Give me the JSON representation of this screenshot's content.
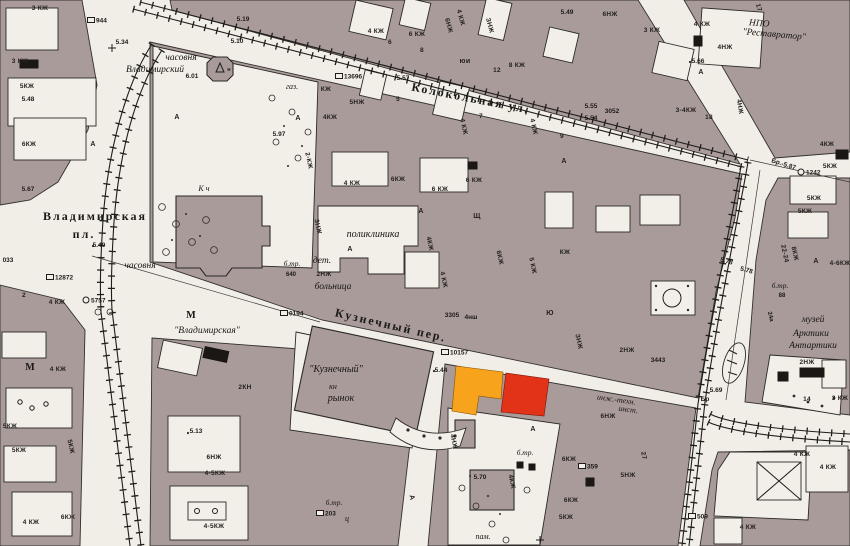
{
  "map": {
    "colors": {
      "paper": "#f1eee7",
      "block": "#a89b9a",
      "outline": "#33302d",
      "highlight_orange": "#F7A41C",
      "highlight_red": "#E23318"
    },
    "highlights": {
      "orange_building": {
        "color": "#F7A41C",
        "description": "highlighted building orange"
      },
      "red_building": {
        "color": "#E23318",
        "description": "highlighted building red"
      }
    },
    "street_labels": [
      {
        "text": "Колокольная ул.",
        "x": 470,
        "y": 102,
        "r": 11
      },
      {
        "text": "Кузнечный пер.",
        "x": 390,
        "y": 329,
        "r": 13
      },
      {
        "text": "Владимирская",
        "x": 95,
        "y": 220,
        "r": 0
      },
      {
        "text": "пл.",
        "x": 84,
        "y": 238,
        "r": 0
      }
    ],
    "place_labels": [
      {
        "text": "часовня",
        "x": 181,
        "y": 60
      },
      {
        "text": "Владимирский",
        "x": 155,
        "y": 72
      },
      {
        "text": "газ.",
        "x": 292,
        "y": 89,
        "s": 8
      },
      {
        "text": "К ч",
        "x": 204,
        "y": 191,
        "s": 8
      },
      {
        "text": "часовня",
        "x": 140,
        "y": 268
      },
      {
        "text": "М",
        "x": 191,
        "y": 318,
        "s": 10,
        "b": 1
      },
      {
        "text": "\"Владимирская\"",
        "x": 207,
        "y": 333
      },
      {
        "text": "поликлиника",
        "x": 373,
        "y": 237,
        "s": 10
      },
      {
        "text": "дет.",
        "x": 322,
        "y": 263
      },
      {
        "text": "больница",
        "x": 333,
        "y": 289
      },
      {
        "text": "б.тр.",
        "x": 292,
        "y": 266,
        "s": 7.5
      },
      {
        "text": "\"Кузнечный\"",
        "x": 336,
        "y": 372,
        "s": 10
      },
      {
        "text": "кн",
        "x": 333,
        "y": 389,
        "s": 8
      },
      {
        "text": "рынок",
        "x": 341,
        "y": 401,
        "s": 10
      },
      {
        "text": "НПО",
        "x": 759,
        "y": 26,
        "r": 5
      },
      {
        "text": "\"Реставратор\"",
        "x": 774,
        "y": 37,
        "r": 5
      },
      {
        "text": "музей",
        "x": 813,
        "y": 322
      },
      {
        "text": "Арктики",
        "x": 811,
        "y": 336
      },
      {
        "text": "Антартики",
        "x": 813,
        "y": 348
      },
      {
        "text": "инж.-техн.",
        "x": 616,
        "y": 402,
        "s": 8,
        "r": 8
      },
      {
        "text": "инст.",
        "x": 628,
        "y": 412,
        "s": 8,
        "r": 8
      },
      {
        "text": "б.тр.",
        "x": 525,
        "y": 455,
        "s": 7.5
      },
      {
        "text": "б.тр.",
        "x": 780,
        "y": 288,
        "s": 7.5
      },
      {
        "text": "б.тр.",
        "x": 334,
        "y": 505,
        "s": 7.5
      },
      {
        "text": "пам.",
        "x": 483,
        "y": 539,
        "s": 8
      },
      {
        "text": "М",
        "x": 30,
        "y": 370,
        "s": 10,
        "b": 1
      },
      {
        "text": "ц",
        "x": 347,
        "y": 521,
        "s": 8
      }
    ],
    "building_labels": [
      {
        "text": "3 КЖ",
        "x": 40,
        "y": 10
      },
      {
        "text": "3 КЖ",
        "x": 20,
        "y": 63
      },
      {
        "text": "5КЖ",
        "x": 27,
        "y": 88
      },
      {
        "text": "6КЖ",
        "x": 29,
        "y": 146
      },
      {
        "text": "4 КЖ",
        "x": 376,
        "y": 33
      },
      {
        "text": "6 КЖ",
        "x": 417,
        "y": 36
      },
      {
        "text": "6",
        "x": 390,
        "y": 44
      },
      {
        "text": "8",
        "x": 422,
        "y": 52
      },
      {
        "text": "6НЖ",
        "x": 447,
        "y": 26,
        "r": 75
      },
      {
        "text": "4 КЖ",
        "x": 459,
        "y": 18,
        "r": 75
      },
      {
        "text": "ЗНЖ",
        "x": 488,
        "y": 26,
        "r": 75
      },
      {
        "text": "юи",
        "x": 465,
        "y": 63,
        "s": 7
      },
      {
        "text": "8 КЖ",
        "x": 517,
        "y": 67
      },
      {
        "text": "12",
        "x": 497,
        "y": 72
      },
      {
        "text": "5НЖ",
        "x": 357,
        "y": 104
      },
      {
        "text": "4КЖ",
        "x": 330,
        "y": 119
      },
      {
        "text": "5",
        "x": 398,
        "y": 101
      },
      {
        "text": "7",
        "x": 481,
        "y": 118
      },
      {
        "text": "4 КЖ",
        "x": 462,
        "y": 127,
        "r": 78
      },
      {
        "text": "4 КЖ",
        "x": 532,
        "y": 127,
        "r": 78
      },
      {
        "text": "9",
        "x": 562,
        "y": 138
      },
      {
        "text": "6НЖ",
        "x": 610,
        "y": 16
      },
      {
        "text": "3 КЖ",
        "x": 652,
        "y": 32
      },
      {
        "text": "4 КЖ",
        "x": 702,
        "y": 26
      },
      {
        "text": "4НЖ",
        "x": 725,
        "y": 49
      },
      {
        "text": "3-4КЖ",
        "x": 686,
        "y": 112
      },
      {
        "text": "18",
        "x": 709,
        "y": 119
      },
      {
        "text": "4НЖ",
        "x": 738,
        "y": 107,
        "r": 80
      },
      {
        "text": "17",
        "x": 757,
        "y": 8,
        "r": 75
      },
      {
        "text": "4КЖ",
        "x": 827,
        "y": 146
      },
      {
        "text": "5КЖ",
        "x": 830,
        "y": 168
      },
      {
        "text": "5КЖ",
        "x": 814,
        "y": 200
      },
      {
        "text": "5КЖ",
        "x": 805,
        "y": 213
      },
      {
        "text": "22-24",
        "x": 783,
        "y": 254,
        "r": 78
      },
      {
        "text": "8КЖ",
        "x": 793,
        "y": 254,
        "r": 78
      },
      {
        "text": "4-6КЖ",
        "x": 840,
        "y": 265
      },
      {
        "text": "2НЖ",
        "x": 807,
        "y": 364
      },
      {
        "text": "3 КЖ",
        "x": 840,
        "y": 400
      },
      {
        "text": "14",
        "x": 807,
        "y": 401
      },
      {
        "text": "4 КЖ",
        "x": 802,
        "y": 456
      },
      {
        "text": "4 КЖ",
        "x": 828,
        "y": 469
      },
      {
        "text": "4 КЖ",
        "x": 748,
        "y": 529
      },
      {
        "text": "2НЖ",
        "x": 627,
        "y": 352
      },
      {
        "text": "6НЖ",
        "x": 608,
        "y": 418
      },
      {
        "text": "ЗНЖ",
        "x": 577,
        "y": 342,
        "r": 78
      },
      {
        "text": "4НЖ",
        "x": 452,
        "y": 442,
        "r": 78
      },
      {
        "text": "4КЖ",
        "x": 510,
        "y": 482,
        "r": 78
      },
      {
        "text": "6КЖ",
        "x": 569,
        "y": 461
      },
      {
        "text": "6КЖ",
        "x": 571,
        "y": 502
      },
      {
        "text": "5КЖ",
        "x": 566,
        "y": 519
      },
      {
        "text": "5НЖ",
        "x": 628,
        "y": 477
      },
      {
        "text": "27",
        "x": 642,
        "y": 456,
        "r": 78
      },
      {
        "text": "4 КЖ",
        "x": 58,
        "y": 371
      },
      {
        "text": "5КЖ",
        "x": 10,
        "y": 428
      },
      {
        "text": "5КЖ",
        "x": 19,
        "y": 452
      },
      {
        "text": "5КЖ",
        "x": 69,
        "y": 447,
        "r": 78
      },
      {
        "text": "6КЖ",
        "x": 68,
        "y": 519
      },
      {
        "text": "4 КЖ",
        "x": 31,
        "y": 524
      },
      {
        "text": "6НЖ",
        "x": 214,
        "y": 459
      },
      {
        "text": "4-5КЖ",
        "x": 215,
        "y": 475
      },
      {
        "text": "4-5КЖ",
        "x": 214,
        "y": 528
      },
      {
        "text": "2КН",
        "x": 245,
        "y": 389
      },
      {
        "text": "4 КЖ",
        "x": 57,
        "y": 304
      },
      {
        "text": "2",
        "x": 24,
        "y": 297
      },
      {
        "text": "4 КЖ",
        "x": 352,
        "y": 185
      },
      {
        "text": "6КЖ",
        "x": 398,
        "y": 181
      },
      {
        "text": "6 КЖ",
        "x": 440,
        "y": 191
      },
      {
        "text": "6 КЖ",
        "x": 474,
        "y": 182
      },
      {
        "text": "ЗНЖ",
        "x": 316,
        "y": 227,
        "r": 78
      },
      {
        "text": "Щ",
        "x": 477,
        "y": 218,
        "s": 7
      },
      {
        "text": "6КЖ",
        "x": 498,
        "y": 258,
        "r": 78
      },
      {
        "text": "5 КЖ",
        "x": 531,
        "y": 266,
        "r": 78
      },
      {
        "text": "КЖ",
        "x": 565,
        "y": 254
      },
      {
        "text": "Ю",
        "x": 550,
        "y": 315,
        "s": 7
      },
      {
        "text": "4 КЖ",
        "x": 442,
        "y": 280,
        "r": 78
      },
      {
        "text": "4КЖ",
        "x": 428,
        "y": 244,
        "r": 78
      },
      {
        "text": "2-КЖ",
        "x": 307,
        "y": 161,
        "r": 78
      },
      {
        "text": "КЖ",
        "x": 326,
        "y": 91
      },
      {
        "text": "2НЖ",
        "x": 324,
        "y": 276
      },
      {
        "text": "н",
        "x": 229,
        "y": 71,
        "s": 5.5
      },
      {
        "text": "А",
        "x": 298,
        "y": 120,
        "s": 7
      },
      {
        "text": "А",
        "x": 421,
        "y": 213,
        "s": 7
      },
      {
        "text": "А",
        "x": 564,
        "y": 163,
        "s": 7
      },
      {
        "text": "А",
        "x": 701,
        "y": 74,
        "s": 7
      },
      {
        "text": "А",
        "x": 816,
        "y": 263,
        "s": 7
      },
      {
        "text": "А",
        "x": 533,
        "y": 431,
        "s": 7
      },
      {
        "text": "А",
        "x": 350,
        "y": 251,
        "s": 7
      },
      {
        "text": "А",
        "x": 177,
        "y": 119,
        "s": 7
      },
      {
        "text": "А",
        "x": 410,
        "y": 498,
        "s": 7,
        "r": 78
      },
      {
        "text": "А",
        "x": 93,
        "y": 146,
        "s": 7
      }
    ],
    "elevation_labels": [
      {
        "text": "5.34",
        "x": 122,
        "y": 44
      },
      {
        "text": "5.19",
        "x": 243,
        "y": 21
      },
      {
        "text": "5.10",
        "x": 237,
        "y": 43
      },
      {
        "text": "5.48",
        "x": 28,
        "y": 101
      },
      {
        "text": "5.57",
        "x": 403,
        "y": 80
      },
      {
        "text": "5.49",
        "x": 567,
        "y": 14
      },
      {
        "text": "5.55",
        "x": 591,
        "y": 108
      },
      {
        "text": "3052",
        "x": 612,
        "y": 113
      },
      {
        "text": "5.54",
        "x": 591,
        "y": 120
      },
      {
        "text": "5.66",
        "x": 698,
        "y": 63
      },
      {
        "text": "6.01",
        "x": 192,
        "y": 78
      },
      {
        "text": "5.97",
        "x": 279,
        "y": 136
      },
      {
        "text": "5.40",
        "x": 99,
        "y": 247
      },
      {
        "text": "5.67",
        "x": 28,
        "y": 191
      },
      {
        "text": "033",
        "x": 8,
        "y": 262
      },
      {
        "text": "3305",
        "x": 452,
        "y": 317
      },
      {
        "text": "4нш",
        "x": 471,
        "y": 319
      },
      {
        "text": "5.44",
        "x": 441,
        "y": 372
      },
      {
        "text": "3443",
        "x": 658,
        "y": 362
      },
      {
        "text": "Бр.-5.87",
        "x": 783,
        "y": 166,
        "r": 18
      },
      {
        "text": "5.78",
        "x": 726,
        "y": 263,
        "r": 15
      },
      {
        "text": "5.78",
        "x": 746,
        "y": 272,
        "r": 15
      },
      {
        "text": "5.69",
        "x": 716,
        "y": 392
      },
      {
        "text": "Бр",
        "x": 705,
        "y": 401
      },
      {
        "text": "5.70",
        "x": 480,
        "y": 479
      },
      {
        "text": "88",
        "x": 782,
        "y": 297,
        "s": 6
      },
      {
        "text": "24а",
        "x": 769,
        "y": 317,
        "r": 75,
        "s": 6
      },
      {
        "text": "5.13",
        "x": 196,
        "y": 433
      },
      {
        "text": "640",
        "x": 291,
        "y": 276,
        "s": 6
      }
    ],
    "survey_markers_box": [
      {
        "text": "944",
        "x": 91,
        "y": 20
      },
      {
        "text": "13696",
        "x": 339,
        "y": 76
      },
      {
        "text": "12872",
        "x": 50,
        "y": 277
      },
      {
        "text": "0194",
        "x": 284,
        "y": 313
      },
      {
        "text": "10157",
        "x": 445,
        "y": 352
      },
      {
        "text": "359",
        "x": 582,
        "y": 466
      },
      {
        "text": "203",
        "x": 320,
        "y": 513
      },
      {
        "text": "509",
        "x": 692,
        "y": 516
      }
    ],
    "survey_markers_circle": [
      {
        "text": "5757",
        "x": 86,
        "y": 300
      },
      {
        "text": "1242",
        "x": 801,
        "y": 172
      }
    ]
  }
}
